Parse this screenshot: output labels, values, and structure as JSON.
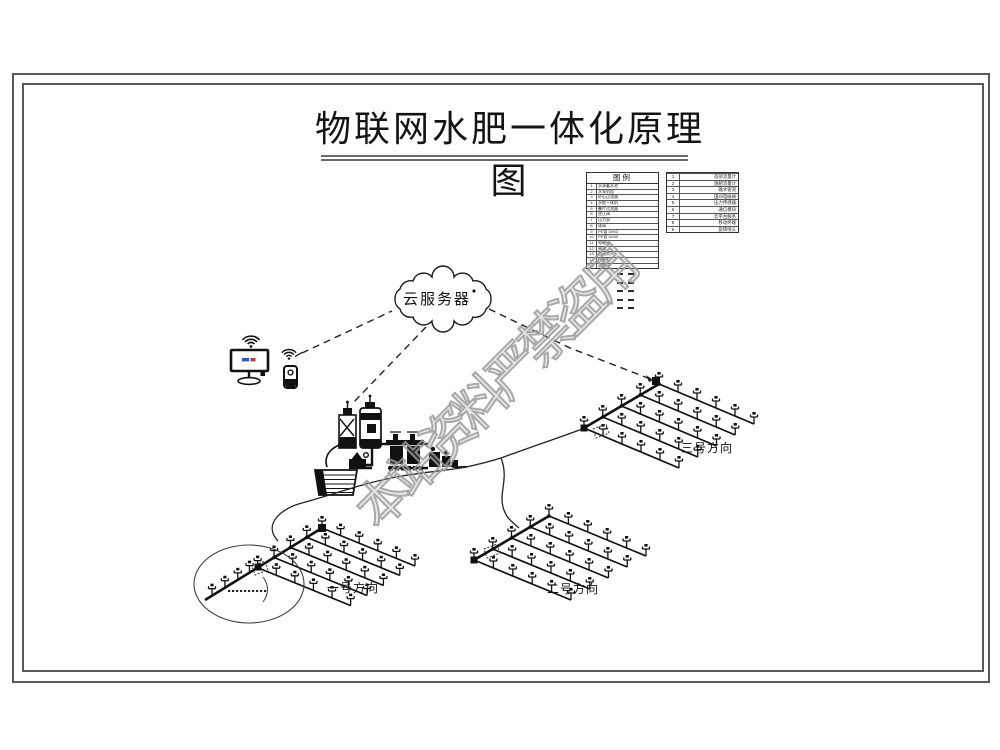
{
  "page": {
    "title": "物联网水肥一体化原理图"
  },
  "watermark": {
    "text": "本站资料严禁盗用",
    "color": "#9b9b9b"
  },
  "diagram": {
    "cloud_label": "云服务器",
    "fields": [
      {
        "label": "一号方向"
      },
      {
        "label": "二号方向"
      },
      {
        "label": "三号方向"
      }
    ]
  },
  "legend_main": {
    "title": "图例",
    "items": [
      {
        "no": "1",
        "name": "水源蓄水池"
      },
      {
        "no": "2",
        "name": "水泵机组"
      },
      {
        "no": "3",
        "name": "砂石过滤器"
      },
      {
        "no": "4",
        "name": "水肥一体机"
      },
      {
        "no": "5",
        "name": "叠片过滤器"
      },
      {
        "no": "6",
        "name": "逆止阀"
      },
      {
        "no": "7",
        "name": "压力表"
      },
      {
        "no": "8",
        "name": "球阀"
      },
      {
        "no": "9",
        "name": "PE管 De63"
      },
      {
        "no": "10",
        "name": "PE管 De50"
      },
      {
        "no": "11",
        "name": "电磁阀"
      },
      {
        "no": "12",
        "name": "闸阀"
      },
      {
        "no": "13",
        "name": "自动喷头"
      },
      {
        "no": "14",
        "name": "控制柜"
      },
      {
        "no": "15",
        "name": "流量计"
      }
    ]
  },
  "legend_right": {
    "items": [
      {
        "no": "1",
        "name": "首部流量计"
      },
      {
        "no": "2",
        "name": "施肥流量计"
      },
      {
        "no": "3",
        "name": "输水管道"
      },
      {
        "no": "4",
        "name": "田间电磁阀"
      },
      {
        "no": "5",
        "name": "压力传感器"
      },
      {
        "no": "6",
        "name": "通信模块"
      },
      {
        "no": "7",
        "name": "云平台服务"
      },
      {
        "no": "8",
        "name": "移动终端"
      },
      {
        "no": "9",
        "name": "旋转喷头"
      }
    ]
  },
  "colors": {
    "line": "#1a1a1a",
    "frame": "#5a5a5a",
    "watermark": "#9b9b9b"
  }
}
